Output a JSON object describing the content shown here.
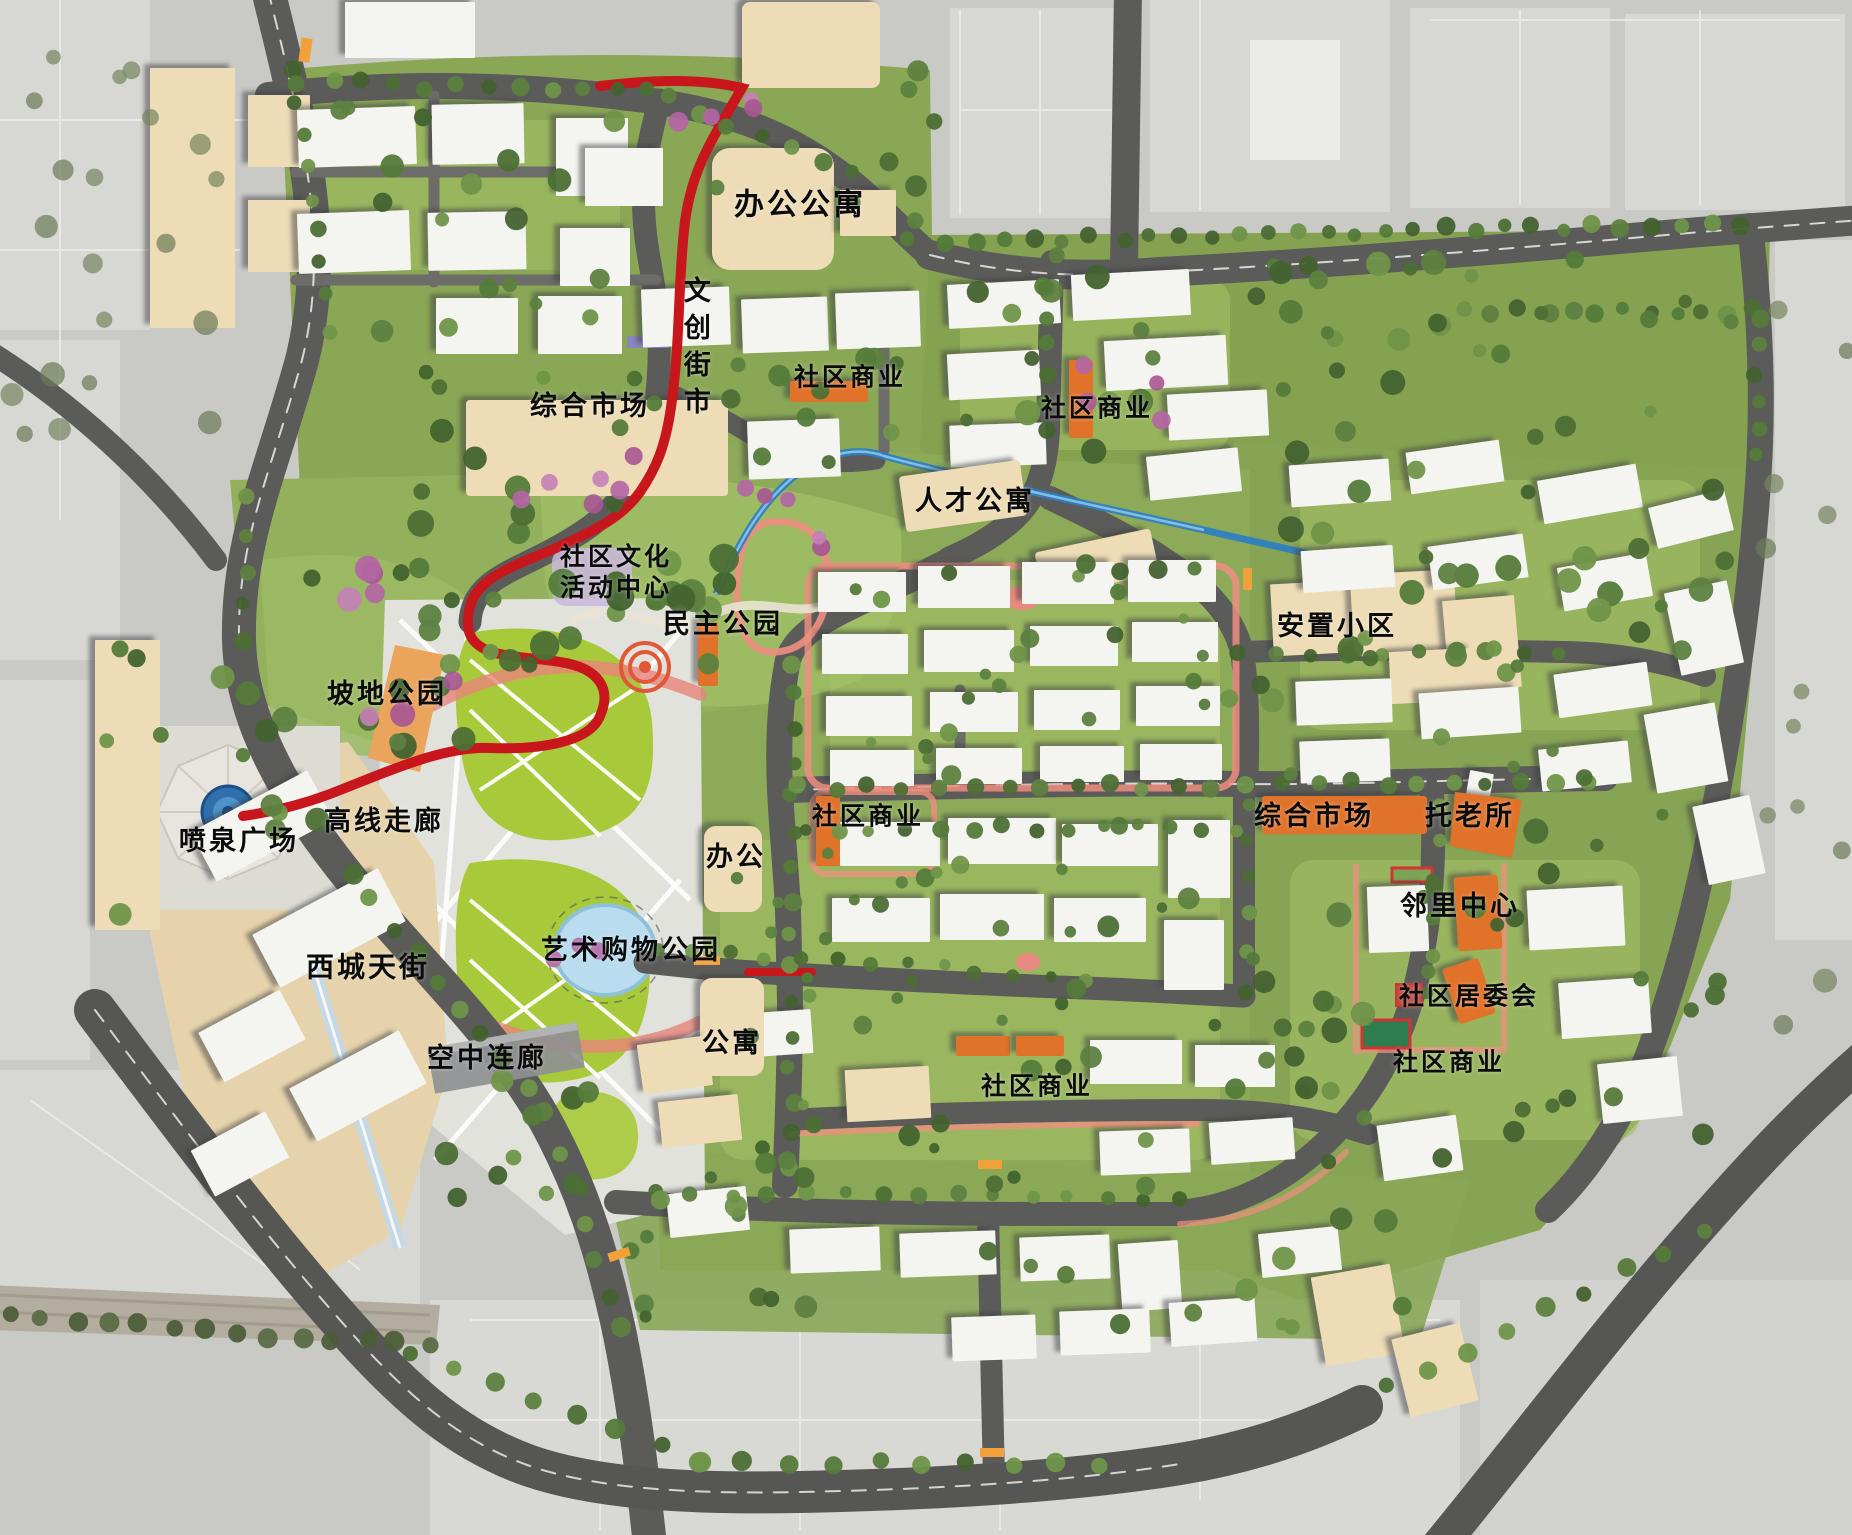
{
  "map": {
    "type": "urban-master-plan",
    "labels": [
      {
        "id": "office-apartment",
        "text": "办公公寓",
        "x": 800,
        "y": 205,
        "size": 30
      },
      {
        "id": "cultural-street-market",
        "text": "文创街市",
        "x": 694,
        "y": 350,
        "size": 27,
        "vertical": true
      },
      {
        "id": "market-north",
        "text": "综合市场",
        "x": 590,
        "y": 407,
        "size": 27
      },
      {
        "id": "community-commerce-1",
        "text": "社区商业",
        "x": 850,
        "y": 377,
        "size": 25
      },
      {
        "id": "community-commerce-2",
        "text": "社区商业",
        "x": 1097,
        "y": 408,
        "size": 25
      },
      {
        "id": "talent-apartment",
        "text": "人才公寓",
        "x": 975,
        "y": 502,
        "size": 27
      },
      {
        "id": "community-culture-center",
        "text": "社区文化活动中心",
        "x": 616,
        "y": 572,
        "size": 25,
        "lines": [
          "社区文化",
          "活动中心"
        ]
      },
      {
        "id": "democracy-park",
        "text": "民主公园",
        "x": 723,
        "y": 625,
        "size": 27
      },
      {
        "id": "slope-park",
        "text": "坡地公园",
        "x": 387,
        "y": 695,
        "size": 27
      },
      {
        "id": "resettlement-community",
        "text": "安置小区",
        "x": 1337,
        "y": 627,
        "size": 27
      },
      {
        "id": "highline-corridor",
        "text": "高线走廊",
        "x": 384,
        "y": 822,
        "size": 27
      },
      {
        "id": "fountain-plaza",
        "text": "喷泉广场",
        "x": 239,
        "y": 842,
        "size": 27
      },
      {
        "id": "community-commerce-3",
        "text": "社区商业",
        "x": 868,
        "y": 816,
        "size": 25
      },
      {
        "id": "market-central",
        "text": "综合市场",
        "x": 1314,
        "y": 817,
        "size": 27
      },
      {
        "id": "elderly-care-center",
        "text": "托老所",
        "x": 1470,
        "y": 817,
        "size": 27
      },
      {
        "id": "office",
        "text": "办公",
        "x": 736,
        "y": 858,
        "size": 27
      },
      {
        "id": "neighborhood-center",
        "text": "邻里中心",
        "x": 1460,
        "y": 907,
        "size": 27
      },
      {
        "id": "art-shopping-park",
        "text": "艺术购物公园",
        "x": 631,
        "y": 951,
        "size": 27
      },
      {
        "id": "west-city-street",
        "text": "西城天街",
        "x": 368,
        "y": 967,
        "size": 28
      },
      {
        "id": "community-committee",
        "text": "社区居委会",
        "x": 1469,
        "y": 996,
        "size": 25
      },
      {
        "id": "sky-corridor",
        "text": "空中连廊",
        "x": 487,
        "y": 1059,
        "size": 27
      },
      {
        "id": "apartment",
        "text": "公寓",
        "x": 732,
        "y": 1044,
        "size": 27
      },
      {
        "id": "community-commerce-4",
        "text": "社区商业",
        "x": 1449,
        "y": 1062,
        "size": 25
      },
      {
        "id": "community-commerce-5",
        "text": "社区商业",
        "x": 1037,
        "y": 1086,
        "size": 25
      }
    ],
    "colors": {
      "context_gray": "#c9c9c6",
      "context_block": "#d7d7d3",
      "road": "#5b5b59",
      "road_minor": "#6c6c69",
      "site_green": "#8aa756",
      "park_green": "#9cbb63",
      "lawn_green": "#a8ca3a",
      "building_white": "#f4f4f0",
      "building_cream": "#eddcb6",
      "building_orange": "#e0722a",
      "highline_red": "#c8161d",
      "path_pink": "#ee8e80",
      "stream_blue": "#2e80c2",
      "pond_blue": "#b9ddee",
      "fountain_blue": "#2f6fae",
      "court_green": "#2e7d4f",
      "stone_band": "#b3ada0",
      "glass_blue": "#c5d9e4"
    }
  }
}
